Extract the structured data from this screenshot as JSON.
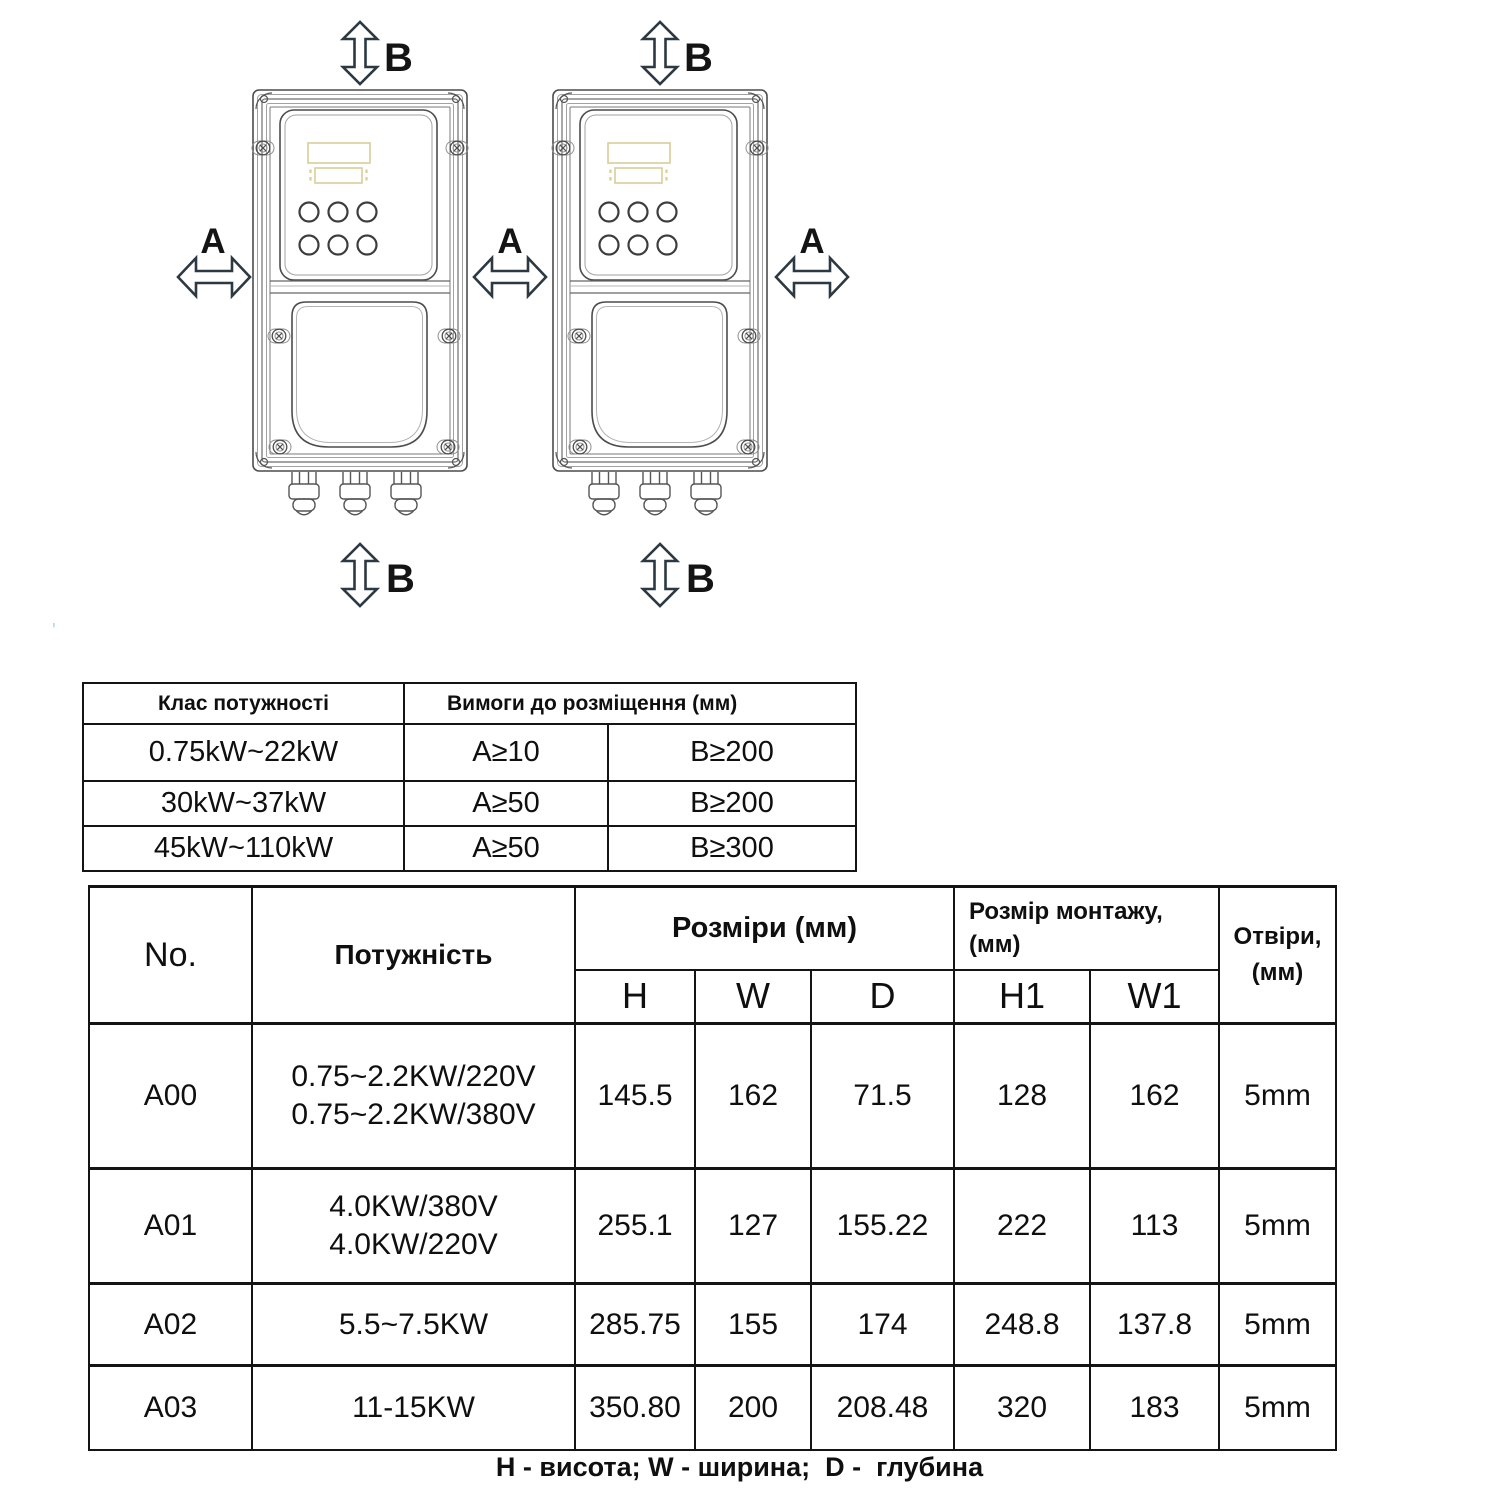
{
  "diagram": {
    "arrow_labels": {
      "a": "A",
      "b": "B"
    }
  },
  "stray_mark": "'",
  "placement_table": {
    "header": {
      "power_class": "Клас потужності",
      "requirements": "Вимоги до розміщення (мм)"
    },
    "rows": [
      {
        "power_class": "0.75kW~22kW",
        "a": "A≥10",
        "b": "B≥200"
      },
      {
        "power_class": "30kW~37kW",
        "a": "A≥50",
        "b": "B≥200"
      },
      {
        "power_class": "45kW~110kW",
        "a": "A≥50",
        "b": "B≥300"
      }
    ]
  },
  "dimensions_table": {
    "headers": {
      "no": "No.",
      "power": "Потужність",
      "dimensions": "Розміри (мм)",
      "h": "H",
      "w": "W",
      "d": "D",
      "mounting_line1": "Розмір монтажу,",
      "mounting_line2": "(мм)",
      "h1": "H1",
      "w1": "W1",
      "holes_line1": "Отвіри,",
      "holes_line2": "(мм)"
    },
    "rows": [
      {
        "no": "A00",
        "power_line1": "0.75~2.2KW/220V",
        "power_line2": "0.75~2.2KW/380V",
        "h": "145.5",
        "w": "162",
        "d": "71.5",
        "h1": "128",
        "w1": "162",
        "holes": "5mm"
      },
      {
        "no": "A01",
        "power_line1": "4.0KW/380V",
        "power_line2": "4.0KW/220V",
        "h": "255.1",
        "w": "127",
        "d": "155.22",
        "h1": "222",
        "w1": "113",
        "holes": "5mm"
      },
      {
        "no": "A02",
        "power_line1": "5.5~7.5KW",
        "power_line2": "",
        "h": "285.75",
        "w": "155",
        "d": "174",
        "h1": "248.8",
        "w1": "137.8",
        "holes": "5mm"
      },
      {
        "no": "A03",
        "power_line1": "11-15KW",
        "power_line2": "",
        "h": "350.80",
        "w": "200",
        "d": "208.48",
        "h1": "320",
        "w1": "183",
        "holes": "5mm"
      }
    ]
  },
  "footer_note": "H - висота; W - ширина;  D -  глубина"
}
